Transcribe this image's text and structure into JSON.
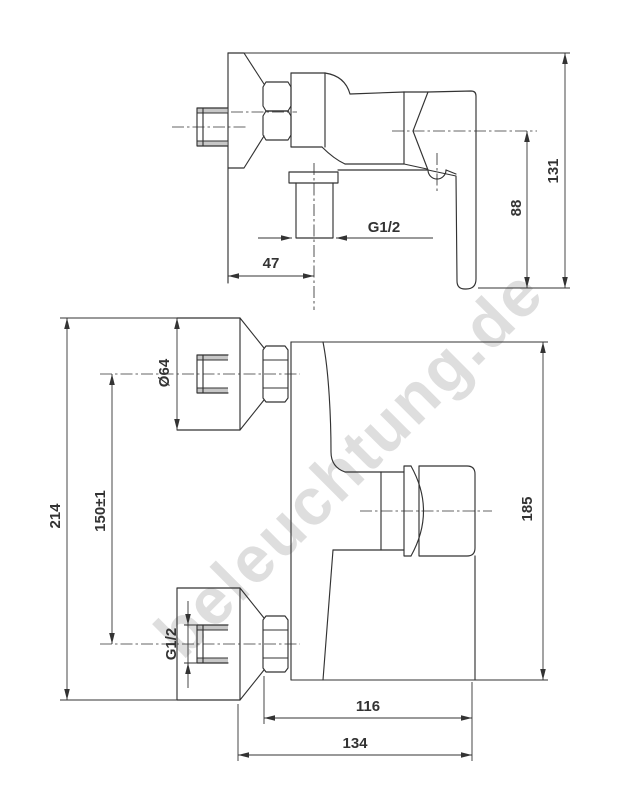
{
  "page": {
    "background": "#ffffff"
  },
  "watermark": {
    "text": "beleuchtung.de",
    "color": "#d6d6d6"
  },
  "drawing": {
    "line_color": "#333333",
    "views": {
      "side": {
        "dims": {
          "d47": "47",
          "g12": "G1/2",
          "d88": "88",
          "d131": "131"
        }
      },
      "front": {
        "dims": {
          "dia64": "Ø64",
          "d214": "214",
          "d150": "150±1",
          "g12": "G1/2",
          "d185": "185",
          "d116": "116",
          "d134": "134"
        }
      }
    }
  }
}
